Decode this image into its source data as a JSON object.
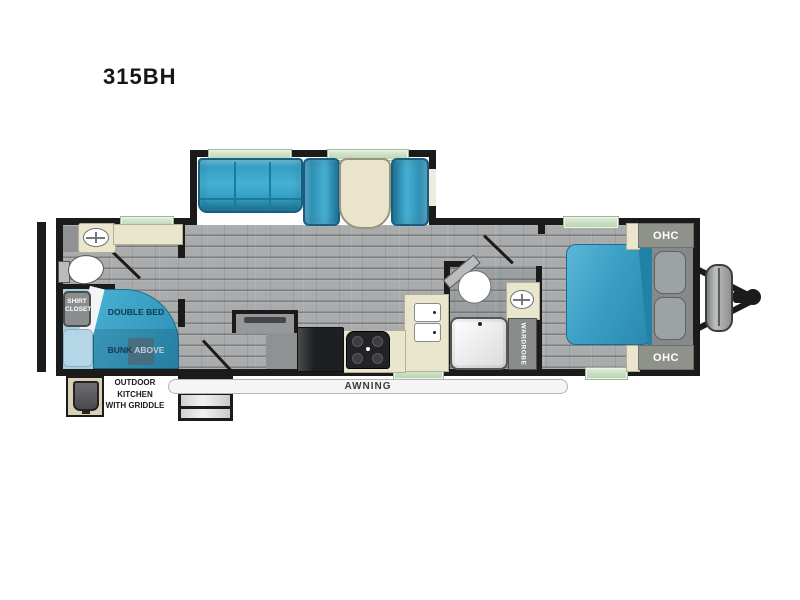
{
  "title": "315BH",
  "floorplan": {
    "bunk_room": {
      "shirt_closet_line1": "SHIRT",
      "shirt_closet_line2": "CLOSET",
      "double_bed": "DOUBLE BED",
      "bunk": "BUNK",
      "bunk_above": "ABOVE"
    },
    "bedroom": {
      "ohc_top": "OHC",
      "ohc_bottom": "OHC",
      "wardrobe": "WARDROBE"
    },
    "exterior": {
      "awning": "AWNING",
      "outdoor_kitchen_line1": "OUTDOOR",
      "outdoor_kitchen_line2": "KITCHEN",
      "outdoor_kitchen_line3": "WITH GRIDDLE"
    }
  },
  "colors": {
    "wall": "#1b1b1b",
    "floor_gray": "#a9abad",
    "accent_blue": "#2f9ec4",
    "light_blue": "#aad1e2",
    "cream": "#eae5cd",
    "window_green": "#c9dfc2",
    "cabinet_gray": "#8c8e90"
  }
}
